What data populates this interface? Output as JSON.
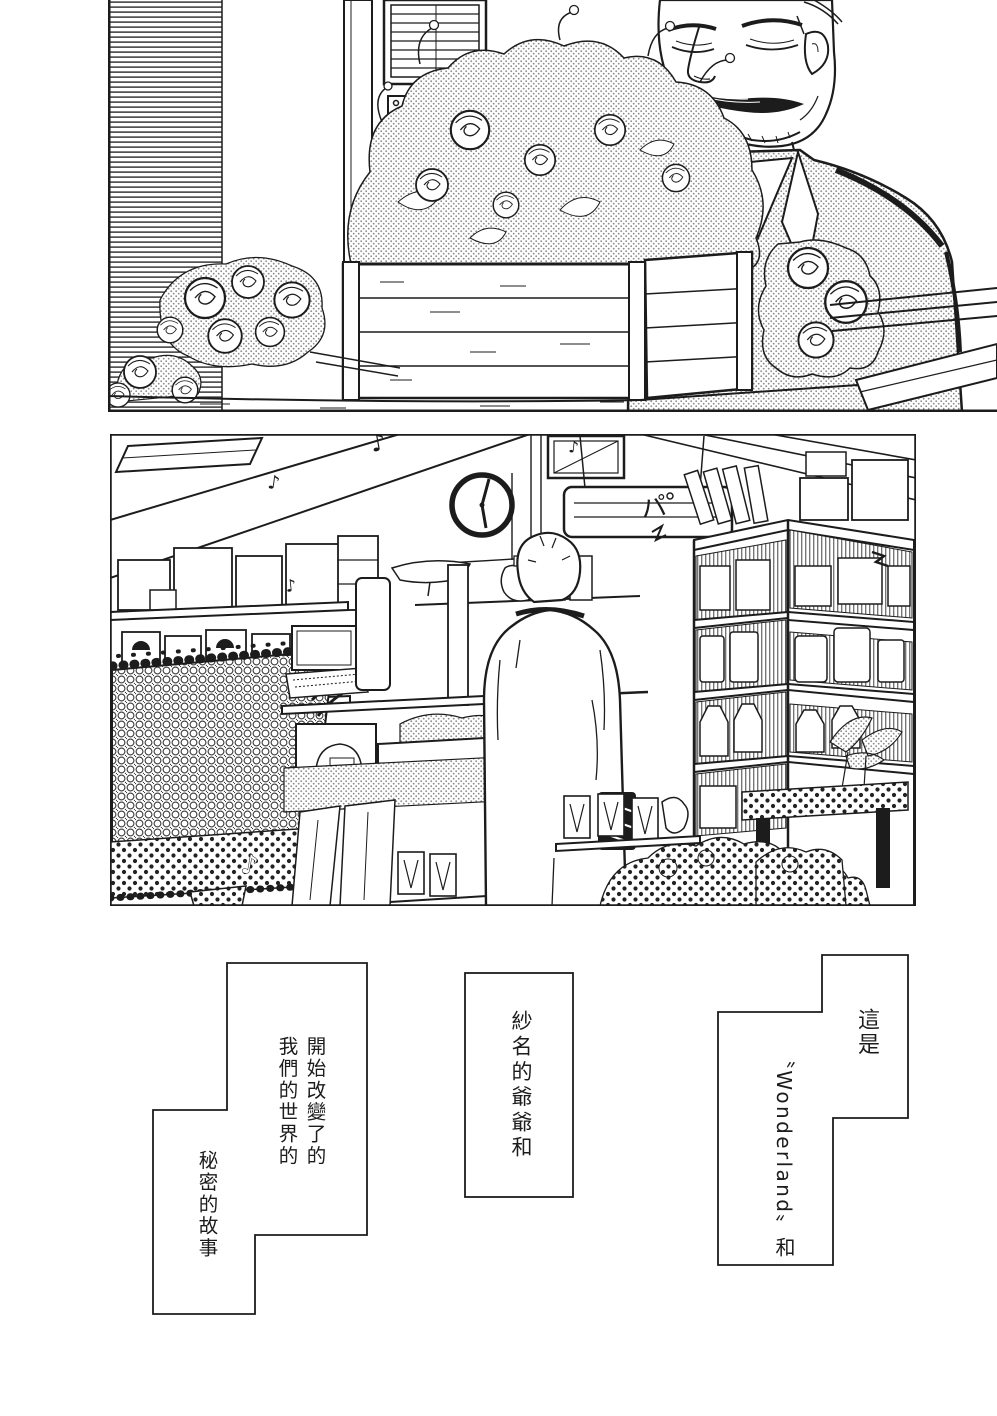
{
  "page": {
    "kind": "manga page",
    "reading_direction": "right-to-left",
    "paper_color": "#ffffff",
    "ink_color": "#1c1c1c"
  },
  "panels": [
    {
      "name": "top-panel",
      "scene": "elderly mustached florist in a halftone-shaded suit standing behind a wooden planter box overflowing with roses; slatted shutter wall, window blinds and a pinned wall poster behind him; loose rose bouquets lying on the counter; wooden ledge at right"
    },
    {
      "name": "middle-panel",
      "scene": "flower-shop interior; a short-haired person seen from behind stands at a counter; shelves stacked with boxes, canisters, jars, vases and cups; wall clock; hanging menu board; wicker basket on a polka-dot stand in the foreground; dotted flower mounds and leafy plants at lower right",
      "sound_effects": [
        "♪",
        "♪",
        "♪",
        "♪",
        "パ"
      ],
      "clock_time_shown": "about 6:00"
    }
  ],
  "captions": {
    "reading_order": [
      "right",
      "middle",
      "left"
    ],
    "right": {
      "lines": [
        "這是",
        "〝Wonderland〟和"
      ]
    },
    "middle": {
      "lines": [
        "紗名的爺爺和"
      ]
    },
    "left": {
      "lines": [
        "開始改變了的",
        "我們的世界的",
        "秘密的故事"
      ]
    }
  },
  "sfx": {
    "note": "♪",
    "pa": "パ"
  }
}
